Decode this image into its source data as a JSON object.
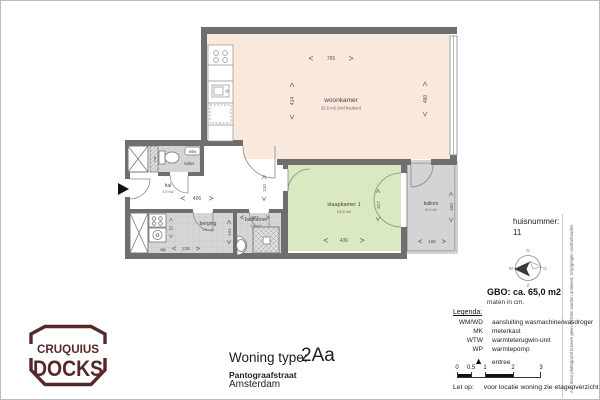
{
  "logo": {
    "line1": "CRUQUIUS",
    "line2": "DOCKS"
  },
  "title_block": {
    "type_label": "Woning type:",
    "type_value": "2Aa",
    "street": "Pantograafstraat",
    "city": "Amsterdam"
  },
  "info_panel": {
    "huisnummer_label": "huisnummer:",
    "huisnummer_value": "11",
    "gbo": "GBO: ca. 65,0 m2",
    "units_note": "maten in cm."
  },
  "legend": {
    "title": "Legenda:",
    "items": [
      {
        "key": "WM/WD",
        "desc": "aansluiting wasmachine/wasdroger"
      },
      {
        "key": "MK",
        "desc": "meterkast"
      },
      {
        "key": "WTW",
        "desc": "warmteterugwin-unit"
      },
      {
        "key": "WP",
        "desc": "warmtepomp"
      }
    ],
    "entree": "entree"
  },
  "scale_bar": {
    "labels": [
      "0",
      "0.5",
      "1",
      "2",
      "3"
    ]
  },
  "note": {
    "prefix": "Let op:",
    "text": "voor locatie woning zie etageoverzicht."
  },
  "disclaimer": "Aan deze plattegrond kunnen geen rechten worden ontleend. Wijzigingen voorbehouden.",
  "compass": {
    "n": "N",
    "o": "O",
    "z": "Z",
    "w": "W"
  },
  "plan": {
    "rooms": {
      "woonkamer": {
        "name": "woonkamer",
        "area": "32.6 m2 (incl keuken)"
      },
      "slaapkamer": {
        "name": "slaapkamer 1",
        "area": "13.8 m2"
      },
      "balkon": {
        "name": "balkon",
        "area": "5.0 m2"
      },
      "hal": {
        "name": "hal",
        "area": "3.9 m2"
      },
      "berging": {
        "name": "berging",
        "area": "3.6 m2"
      },
      "badkamer": {
        "name": "badkamer",
        "area": "3.6 m2"
      },
      "toilet": {
        "name": "toilet"
      }
    },
    "unit_labels": {
      "wtw": "wtw",
      "wp": "wp",
      "mk": "mk"
    },
    "dims": {
      "woonkamer_width": "765",
      "woonkamer_depth": "414",
      "woonkamer_depth_right": "480",
      "hal_width": "406",
      "corridor_width": "120",
      "berging_width": "228",
      "berging_niche": "62",
      "badkamer_width": "207",
      "badkamer_depth": "101",
      "slaapkamer_width": "436",
      "slaapkamer_depth": "317",
      "balkon_width": "186",
      "balkon_depth": "300"
    }
  },
  "colors": {
    "wall": "#6e6e6e",
    "woonkamer_fill": "#f8e9dc",
    "slaapkamer_fill": "#dbe9c3",
    "tile_fill": "#d6d6d6",
    "balkon_fill": "#d4d4d4",
    "logo": "#55282a",
    "entree_marker": "#111111"
  }
}
